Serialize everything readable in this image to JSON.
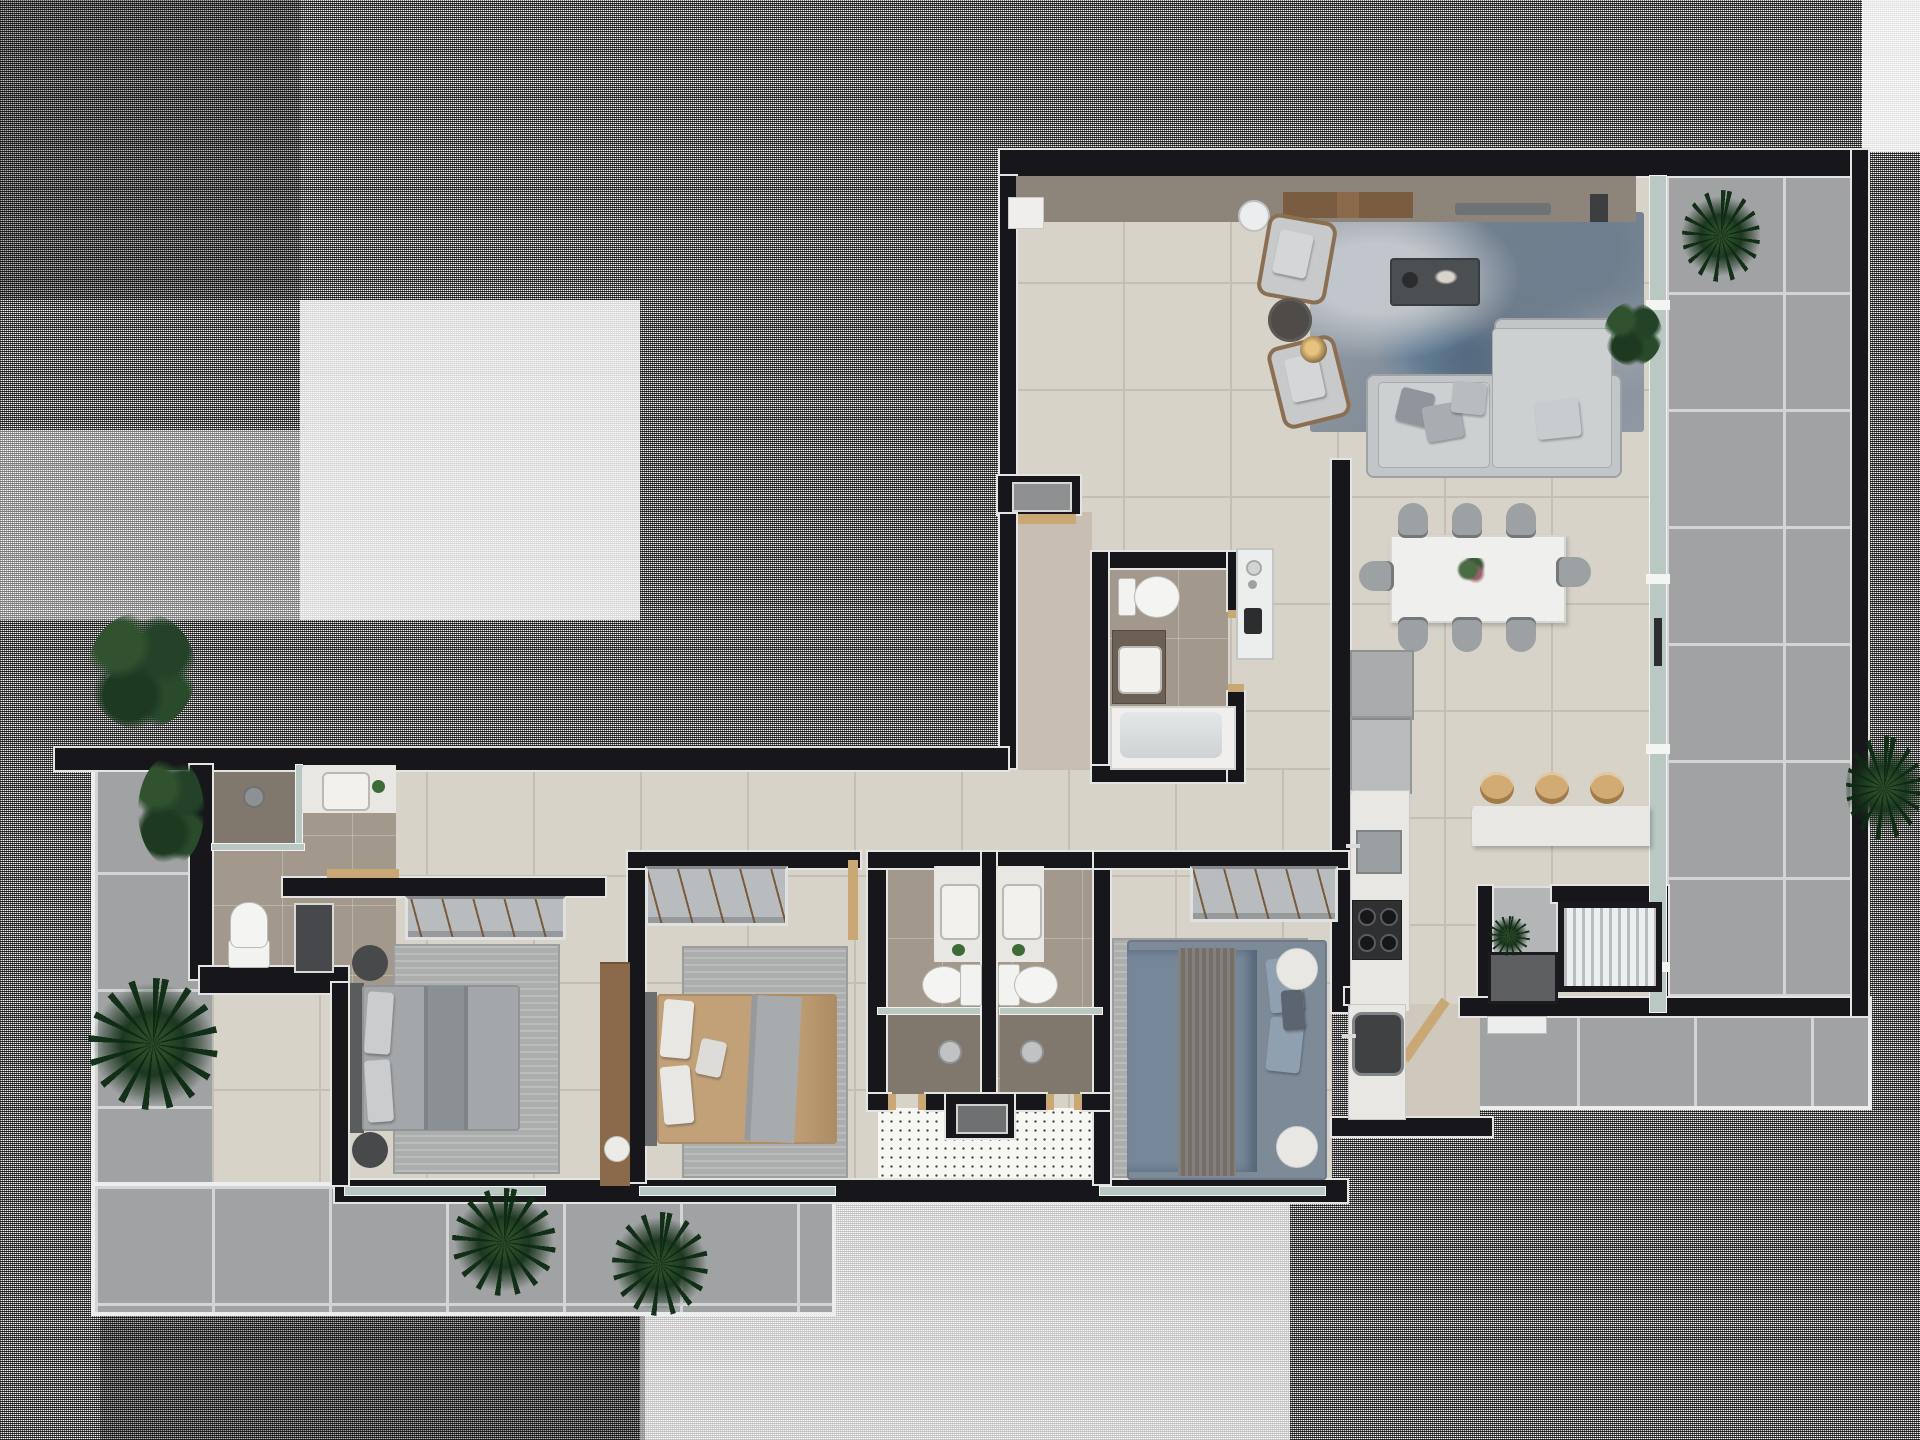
{
  "scene": {
    "type": "3d-floor-plan-top-down-render",
    "description": "photoreal apartment floor plan on halftone-dithered background",
    "rooms": [
      "living-room",
      "dining-area",
      "kitchen",
      "breakfast-bar",
      "entry-niche",
      "powder-bathroom",
      "service-bathroom",
      "corridor",
      "bedroom-left",
      "bedroom-middle",
      "bedroom-right",
      "ensuite-bathroom-left",
      "ensuite-bathroom-right",
      "service-room",
      "ac-utility-area",
      "terrace-left",
      "terrace-bottom",
      "terrace-right",
      "light-well"
    ],
    "furniture_counts": {
      "sofas": 1,
      "armchairs": 2,
      "coffee_tables": 1,
      "side_tables": 5,
      "floor_lamps": 1,
      "tv_consoles": 1,
      "dining_tables": 1,
      "dining_chairs": 8,
      "bar_stools": 3,
      "beds": 3,
      "wardrobes": 3,
      "toilets": 4,
      "sinks": 6,
      "bathtubs": 1,
      "showers": 3,
      "fridges": 1,
      "cooktops": 1,
      "plants": 9,
      "rugs": 4
    }
  },
  "palette": {
    "wall": "#17171b",
    "floor": "#d7d3c9",
    "grout": "#c3bfb5",
    "bathFloor": "#a2988b",
    "showerFloor": "#80776d",
    "terrace": "#a0a2a4",
    "terraceGrout": "#d2d4d5",
    "wood": "#c9a876",
    "woodDark": "#8a6a4a",
    "marble": "#e9e7e3",
    "sofa": "#c3c6c8",
    "pillow": "#9aa0a5",
    "chairGray": "#9da1a4",
    "glass": "#b9c8c3",
    "bedGray": "#a3a7aa",
    "bedTan": "#c2a179",
    "bedBlue": "#7d8b99",
    "plantGreen": "#2a4a28",
    "applianceGray": "#b9babc",
    "counterDark": "#2f3032"
  }
}
